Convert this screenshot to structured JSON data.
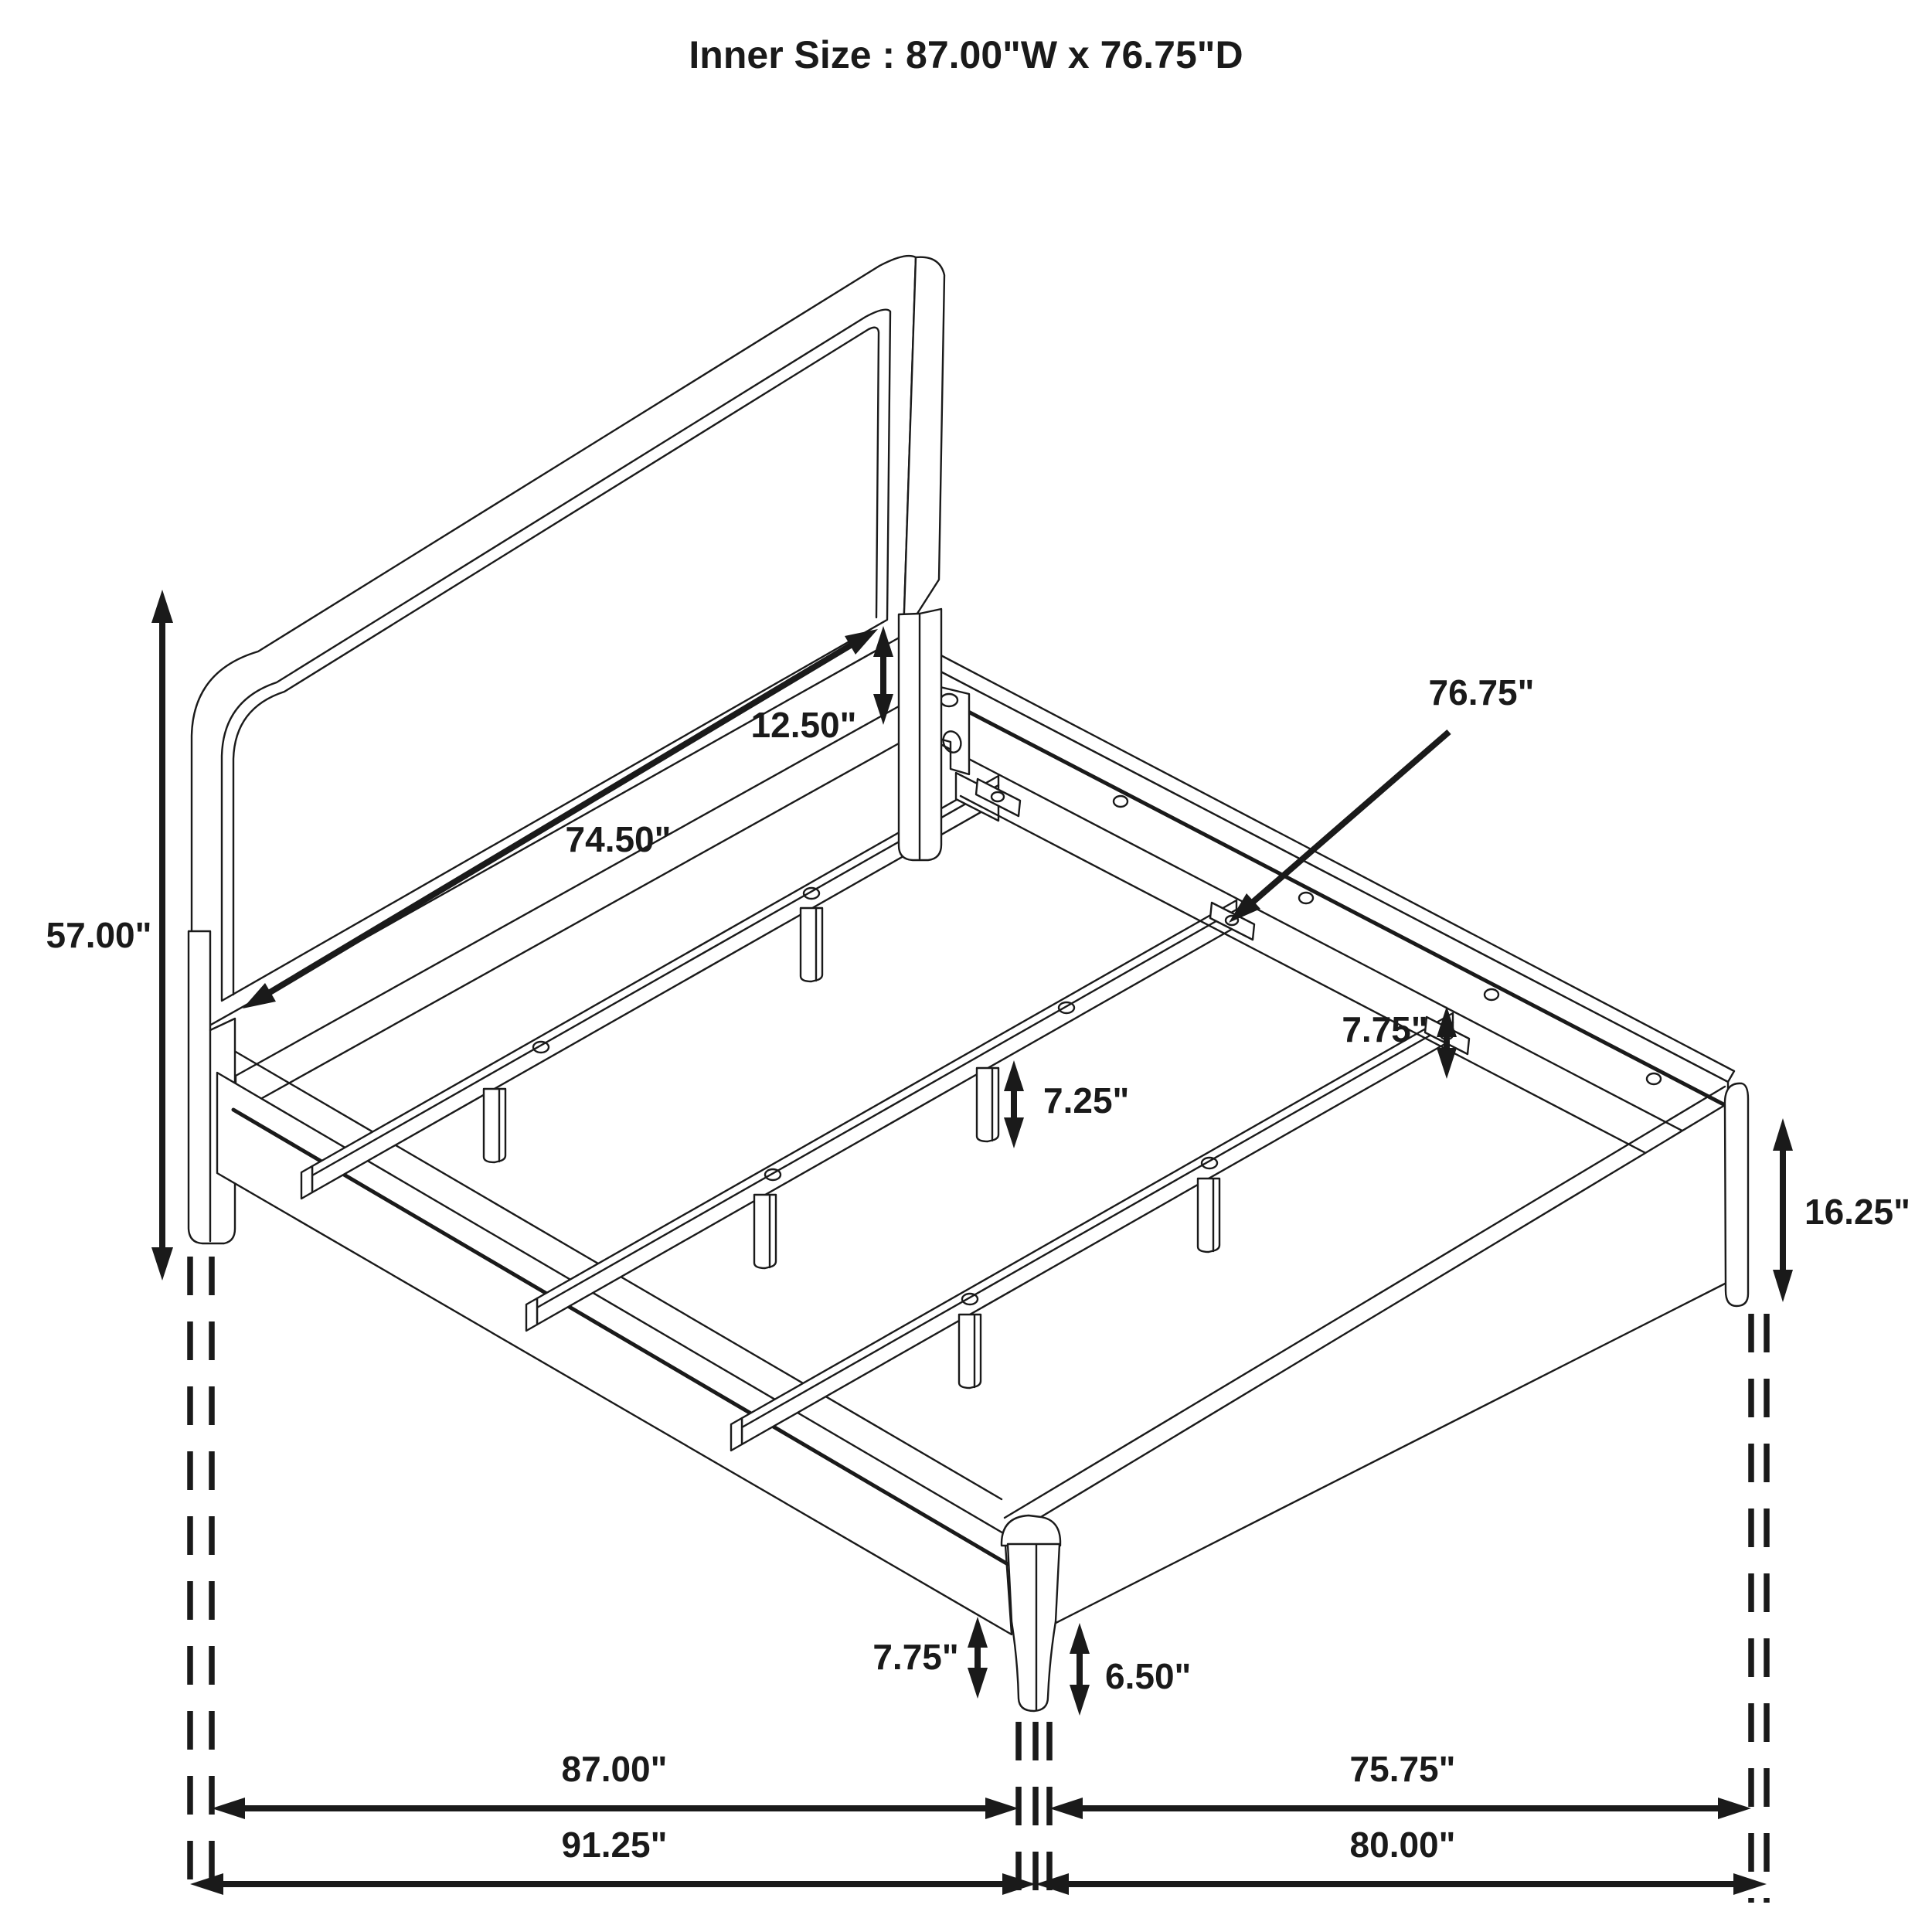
{
  "title": "Inner Size : 87.00\"W x 76.75\"D",
  "colors": {
    "line": "#1a1a1a",
    "background": "#ffffff"
  },
  "units": "inches",
  "dimension_labels": {
    "headboard_panel_height": "12.50\"",
    "headboard_panel_width": "74.50\"",
    "headboard_height": "57.00\"",
    "support_beam_length": "76.75\"",
    "side_rail_height": "7.75\"",
    "beam_leg_height": "7.25\"",
    "footboard_height": "16.25\"",
    "front_rail_floor_clearance": "7.75\"",
    "front_leg_floor_clearance": "6.50\"",
    "inner_width": "87.00\"",
    "inner_depth": "75.75\"",
    "outer_width": "91.25\"",
    "outer_depth": "80.00\""
  }
}
